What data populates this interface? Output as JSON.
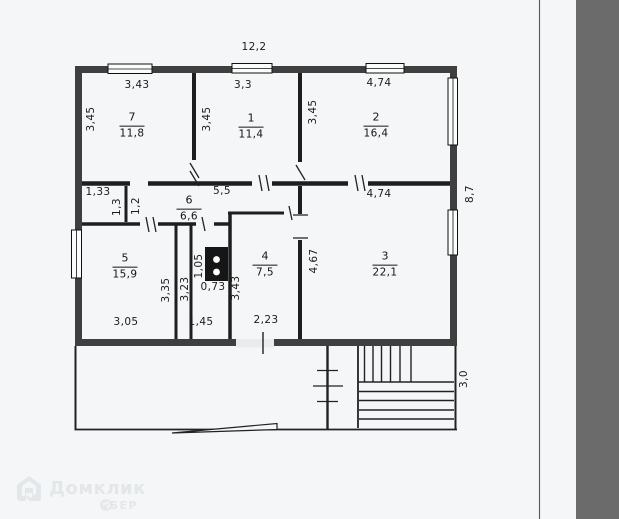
{
  "page": {
    "paper_color": "#f4f6f7",
    "scan_band_color": "#6b6b6b",
    "ink_color": "#1c1c1c",
    "wall_fill_color": "#3f3f3f"
  },
  "watermark": {
    "brand": "Домклик",
    "subbrand": "СБЕР",
    "logo": "house-icon",
    "color": "#e3e7ea"
  },
  "floor_plan": {
    "overall": {
      "top_width": "12,2",
      "right_height": "8,7",
      "porch_depth": "3,0"
    },
    "rooms": {
      "r7": {
        "number": "7",
        "area": "11,8",
        "top": "3,43",
        "side": "3,45"
      },
      "r1": {
        "number": "1",
        "area": "11,4",
        "top": "3,3",
        "side": "3,45"
      },
      "r2": {
        "number": "2",
        "area": "16,4",
        "top": "4,74",
        "side": "3,45"
      },
      "r6": {
        "number": "6",
        "area": "6,6",
        "top": "5,5"
      },
      "r5": {
        "number": "5",
        "area": "15,9",
        "side": "3,35",
        "bottom": "3,05"
      },
      "r4": {
        "number": "4",
        "area": "7,5",
        "side": "3,43",
        "bottom": "2,23"
      },
      "r3": {
        "number": "3",
        "area": "22,1",
        "top": "4,74",
        "side": "4,67"
      }
    },
    "hall": {
      "width": "1,33",
      "height_left": "1,3",
      "height_right": "1,2"
    },
    "utility": {
      "stove_height": "1,05",
      "stove_width": "0,73",
      "shaft_height": "3,23",
      "bottom": "1,45"
    }
  }
}
